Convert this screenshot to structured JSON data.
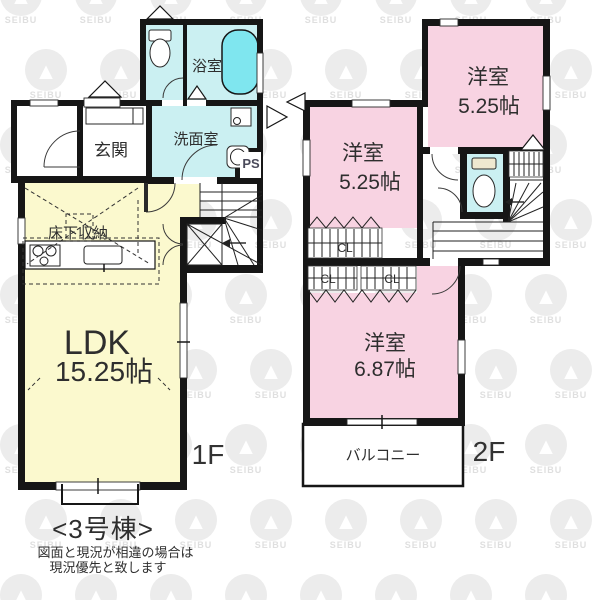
{
  "meta": {
    "title": "<3号棟>",
    "note_line1": "図面と現況が相違の場合は",
    "note_line2": "現況優先と致します"
  },
  "watermark": {
    "brand": "SEIBU",
    "logo_glyph": "▲"
  },
  "colors": {
    "ldk_yellow": "#FBF9CE",
    "bedroom_pink": "#F8D3E2",
    "wet_cyan": "#CBF0F2",
    "tub_cyan": "#7FE6EF",
    "wall_black": "#161616",
    "watermark_circle": "#ececec",
    "watermark_text": "#dfdfdf"
  },
  "floor1": {
    "label": "1F",
    "entrance_label": "玄関",
    "bath_label": "浴室",
    "washroom_label": "洗面室",
    "ps_label": "PS",
    "underfloor_label": "床下収納",
    "ldk_label": "LDK",
    "ldk_size": "15.25帖"
  },
  "floor2": {
    "label": "2F",
    "bedroom_a_label": "洋室",
    "bedroom_a_size": "5.25帖",
    "bedroom_b_label": "洋室",
    "bedroom_b_size": "5.25帖",
    "bedroom_c_label": "洋室",
    "bedroom_c_size": "6.87帖",
    "closet_a_label": "CL",
    "closet_b_label": "CL",
    "closet_c_label": "CL",
    "balcony_label": "バルコニー"
  }
}
